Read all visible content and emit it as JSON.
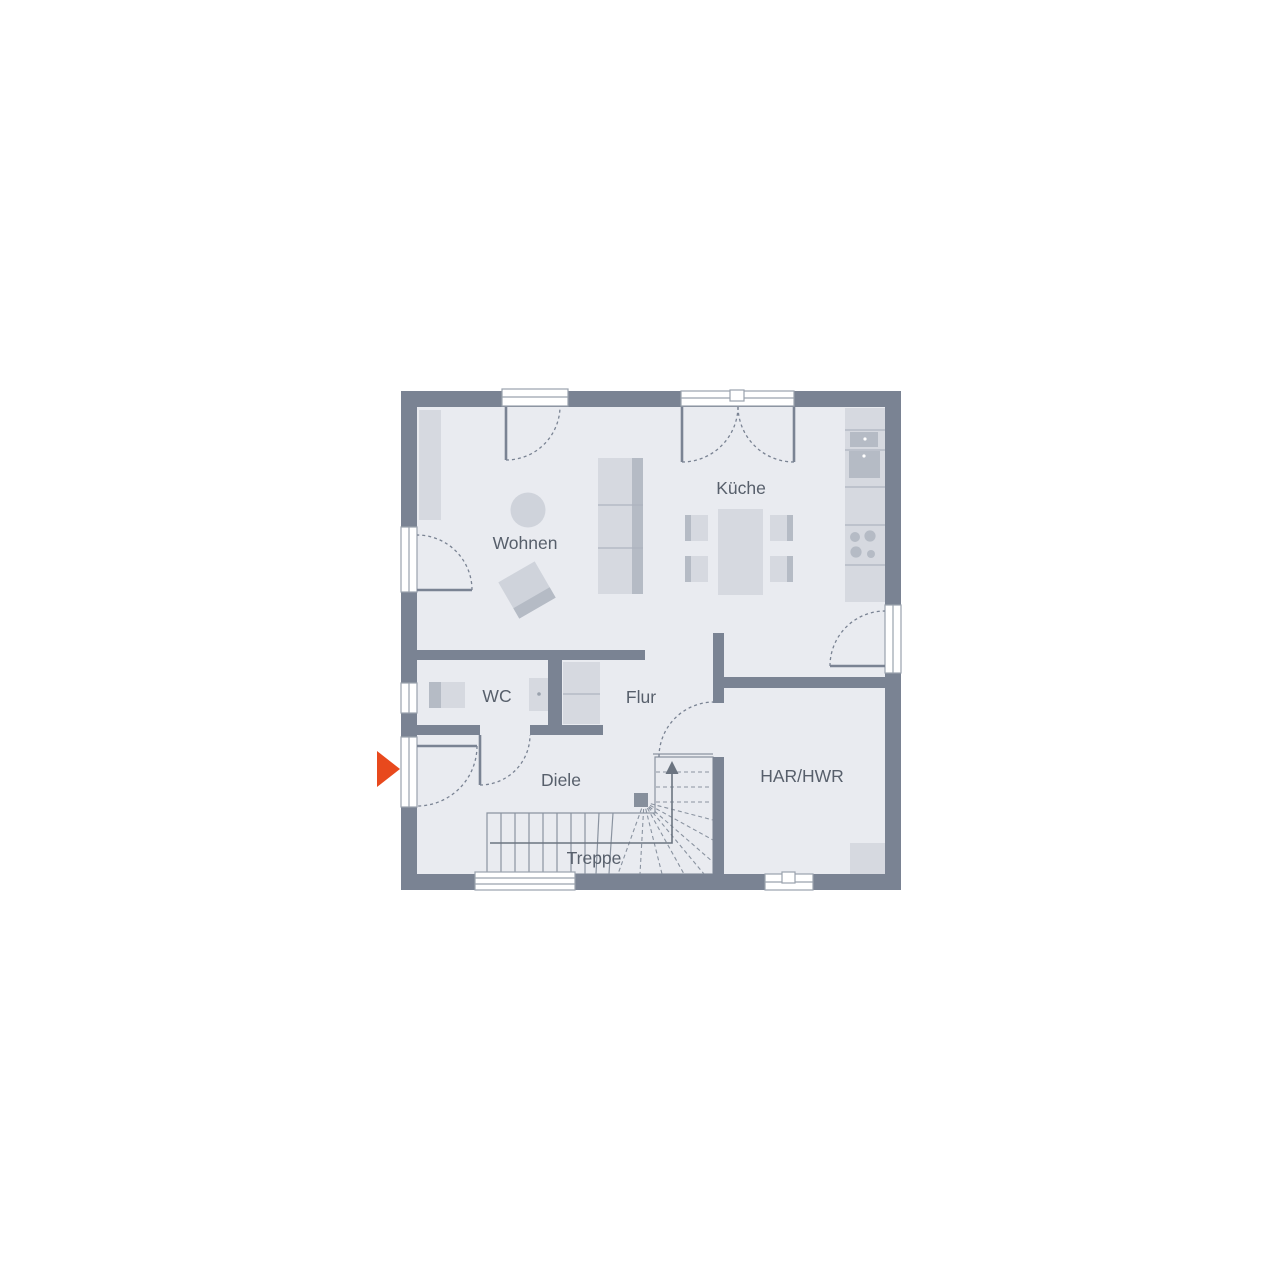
{
  "plan": {
    "rooms": [
      {
        "id": "wohnen",
        "label": "Wohnen"
      },
      {
        "id": "kueche",
        "label": "Küche"
      },
      {
        "id": "wc",
        "label": "WC"
      },
      {
        "id": "flur",
        "label": "Flur"
      },
      {
        "id": "diele",
        "label": "Diele"
      },
      {
        "id": "har-hwr",
        "label": "HAR/HWR"
      },
      {
        "id": "treppe",
        "label": "Treppe"
      }
    ],
    "entrance_marker": {
      "symbol": "arrow-right"
    },
    "colors": {
      "background": "#ffffff",
      "wall": "#7a8393",
      "floor": "#e9ebf0",
      "furniture_light": "#d6d9e0",
      "furniture_mid": "#cfd3db",
      "furniture_dark": "#b5bbc5",
      "furniture_edge": "#aeb4bf",
      "window_frame": "#9aa2ad",
      "stair_line": "#8a93a0",
      "walk_line": "#6b7480",
      "newel": "#868f9c",
      "label_text": "#575f6b",
      "entrance_arrow": "#e8491d"
    }
  }
}
